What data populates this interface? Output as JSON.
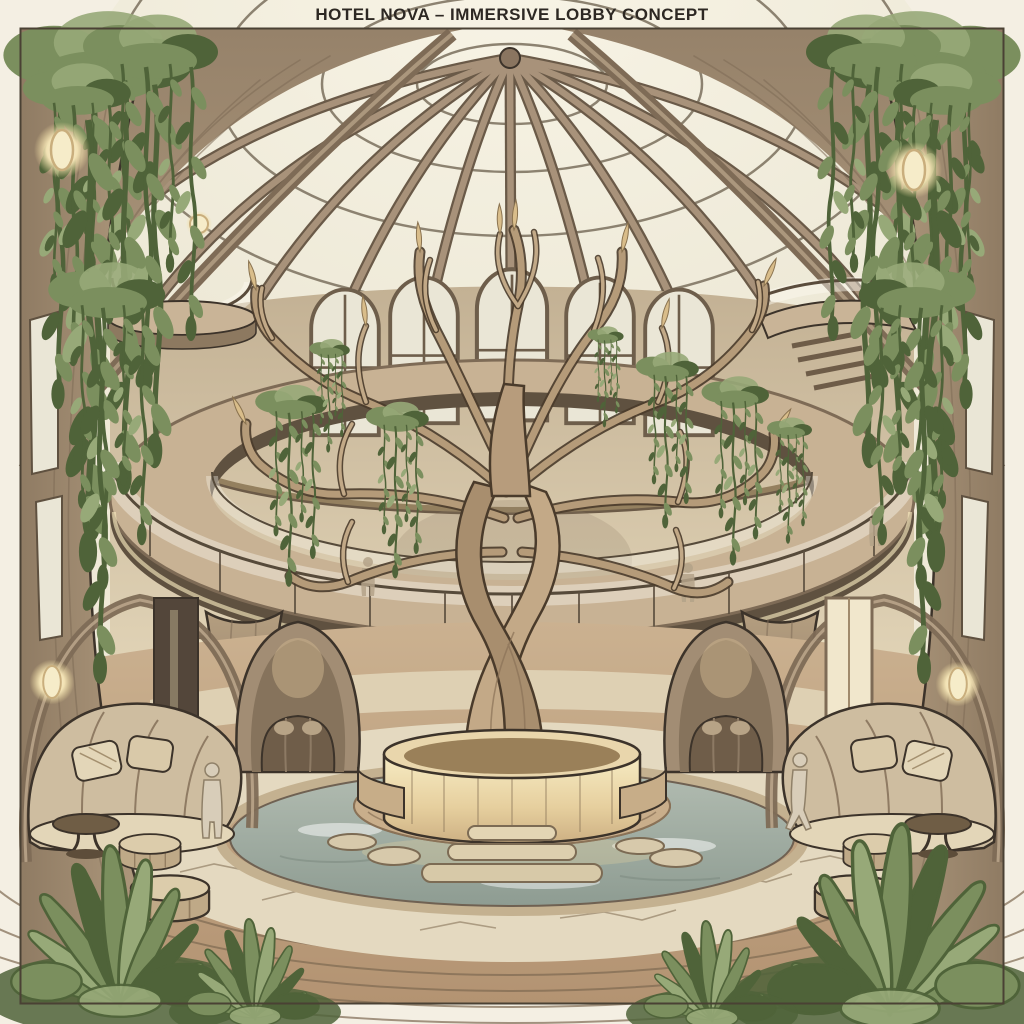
{
  "title": "HOTEL NOVA – IMMERSIVE LOBBY CONCEPT",
  "palette": {
    "paper": "#efe9d7",
    "margin": "#f4efe3",
    "frame": "#4a4134",
    "ink": "#3c332a",
    "titleInk": "#2d2823",
    "wood": "#a8937b",
    "woodD": "#7e6b56",
    "woodP": "#5f5140",
    "woodL": "#c9b497",
    "woodPale": "#ddcbac",
    "glass": "#f4f0e1",
    "pane": "#eae6d6",
    "wall": "#cdbb9e",
    "wallL": "#e7dbbf",
    "leaf": "#7b8f5e",
    "leafD": "#4f6339",
    "leafL": "#97a978",
    "water": "#a9b3a7",
    "waterD": "#87948a",
    "stone": "#e4d9c0",
    "stoneL": "#9d8c72",
    "deck": "#c1a684",
    "deckL": "#7e6a52",
    "glow": "#f5e7bb",
    "glowD": "#d9bd8a",
    "uph": "#cebda0",
    "uphL": "#e3d6b8",
    "uphD": "#8f7b63",
    "sil": "#d8cdb9"
  },
  "scene": {
    "style": "hand-drawn architectural concept sketch",
    "elements": [
      "glass dome skylight",
      "radial timber ribs",
      "central twisted tree sculpture",
      "curved mezzanine walkway with glass railing",
      "hanging plants and vines",
      "two-storey atrium windows",
      "flared timber columns",
      "circular illuminated planter",
      "annular reflecting pool",
      "stepping stones and steps",
      "stone paving",
      "timber deck floor",
      "cocoon seating nooks",
      "curved sofas with cushions",
      "round side tables",
      "pouf stools",
      "oval wall sconces",
      "upper balconies",
      "guest silhouettes",
      "foreground foliage"
    ]
  }
}
